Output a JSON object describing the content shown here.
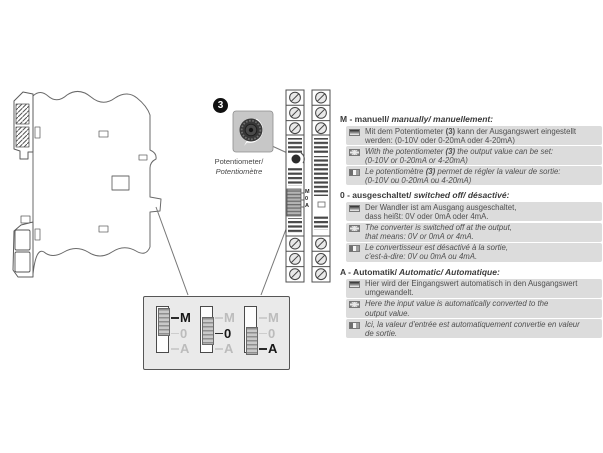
{
  "potentiometer_callout": {
    "badge": "3",
    "label_lines": [
      "Potentiometer/",
      "Potentiomètre"
    ]
  },
  "device_front": {
    "dip_labels": [
      "M",
      "0",
      "A"
    ]
  },
  "dip_detail": {
    "row_labels": [
      "M",
      "0",
      "A"
    ],
    "switches": [
      {
        "active": "M",
        "knob": "top"
      },
      {
        "active": "0",
        "knob": "middle"
      },
      {
        "active": "A",
        "knob": "bottom"
      }
    ]
  },
  "sections": [
    {
      "id": "M",
      "heading_plain": "M - manuell/",
      "heading_italic": "manually/ manuellement:",
      "items": [
        {
          "flag": "de",
          "italic": false,
          "lines": [
            "Mit dem Potentiometer (3) kann der Ausgangswert eingestellt",
            "werden: (0-10V oder 0-20mA oder 4-20mA)"
          ]
        },
        {
          "flag": "gb",
          "italic": true,
          "lines": [
            "With the potentiometer (3) the output value can be set:",
            "(0-10V or 0-20mA or 4-20mA)"
          ]
        },
        {
          "flag": "fr",
          "italic": true,
          "lines": [
            "Le potentiomètre (3) permet de régler la valeur de sortie:",
            "(0-10V ou 0-20mA ou 4-20mA)"
          ]
        }
      ]
    },
    {
      "id": "0",
      "heading_plain": "0 - ausgeschaltet/",
      "heading_italic": "switched off/ désactivé:",
      "items": [
        {
          "flag": "de",
          "italic": false,
          "lines": [
            "Der Wandler ist am Ausgang ausgeschaltet,",
            "dass heißt: 0V oder 0mA oder 4mA."
          ]
        },
        {
          "flag": "gb",
          "italic": true,
          "lines": [
            "The converter is switched off at the output,",
            "that means: 0V or 0mA or 4mA."
          ]
        },
        {
          "flag": "fr",
          "italic": true,
          "lines": [
            "Le convertisseur est désactivé à la sortie,",
            "c'est-à-dire: 0V ou 0mA ou 4mA."
          ]
        }
      ]
    },
    {
      "id": "A",
      "heading_plain": "A - Automatik/",
      "heading_italic": "Automatic/ Automatique:",
      "items": [
        {
          "flag": "de",
          "italic": false,
          "lines": [
            "Hier wird der Eingangswert automatisch in den Ausgangswert",
            "umgewandelt."
          ]
        },
        {
          "flag": "gb",
          "italic": true,
          "lines": [
            "Here the input value is automatically converted to the",
            "output value."
          ]
        },
        {
          "flag": "fr",
          "italic": true,
          "lines": [
            "Ici, la valeur d'entrée est automatiquement convertie en valeur",
            "de sortie."
          ]
        }
      ]
    }
  ],
  "colors": {
    "item_highlight": "#dcdcdc",
    "detail_box": "#eaeaea",
    "pot_square": "#c7c7c7",
    "body_text": "#4f4f4f"
  }
}
